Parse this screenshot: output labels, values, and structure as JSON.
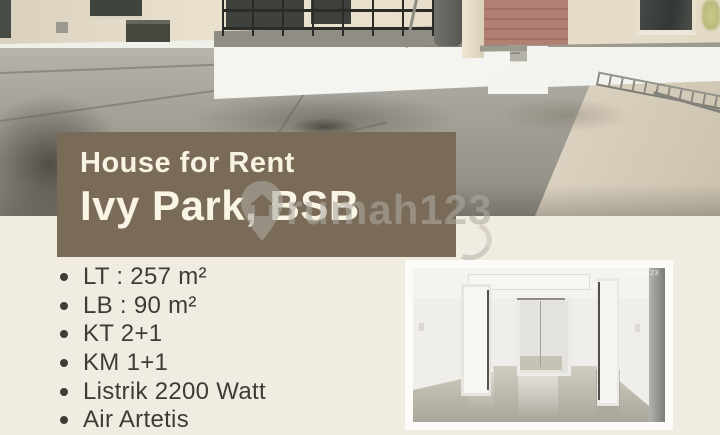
{
  "page": {
    "background_color": "#f1ece1"
  },
  "listing_card": {
    "banner": {
      "title": "House for Rent",
      "subtitle": "Ivy Park, BSB",
      "background_color": "#7a6b58",
      "text_color": "#f8f3e3"
    },
    "details": {
      "items": [
        "LT : 257 m²",
        "LB : 90 m²",
        "KT 2+1",
        "KM 1+1",
        "Listrik 2200 Watt",
        "Air Artetis"
      ],
      "text_color": "#3d3c37"
    },
    "watermark": {
      "text": "rumah123",
      "icon": "map-pin-house-icon"
    },
    "photos": {
      "exterior": "exterior-carport-terrace-photo",
      "interior": "interior-empty-room-photo"
    }
  }
}
